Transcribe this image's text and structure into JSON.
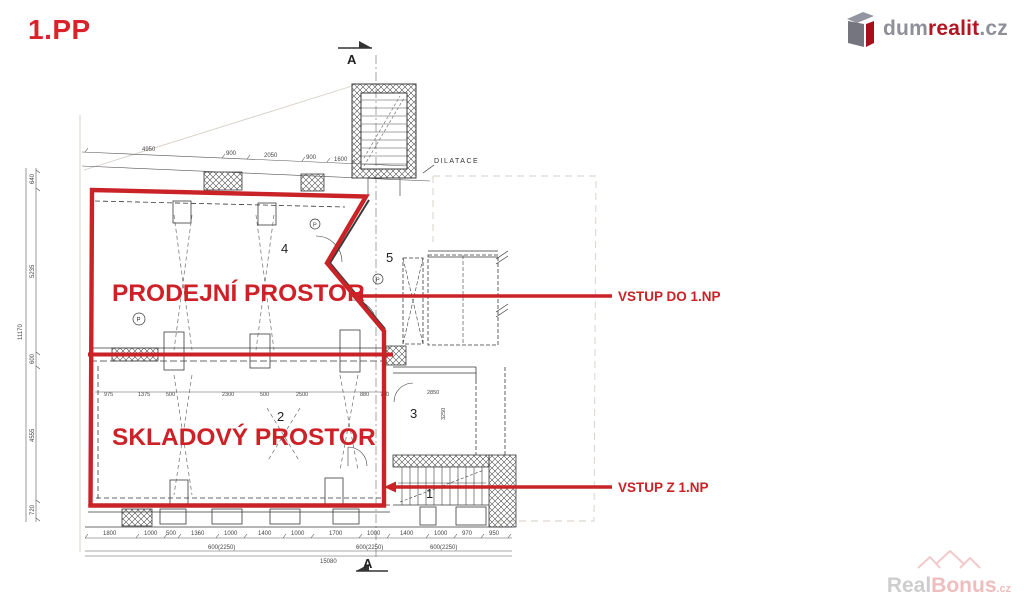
{
  "page": {
    "title": "1.PP"
  },
  "logo": {
    "part1": "dum",
    "part2": "realit",
    "part3": ".cz"
  },
  "watermark": {
    "part1": "Real",
    "part2": "Bonus",
    "part3": ".cz"
  },
  "annotations": {
    "sales_label": "PRODEJNÍ PROSTOR",
    "storage_label": "SKLADOVÝ PROSTOR",
    "entrance_to": "VSTUP DO 1.NP",
    "entrance_from": "VSTUP Z 1.NP",
    "accent_color": "#c92227"
  },
  "plan": {
    "rooms": [
      "1",
      "2",
      "3",
      "4",
      "5"
    ],
    "section_marker": "A",
    "dilatace": "DILATACE",
    "p_symbol": "P",
    "dims": {
      "top": [
        "4950",
        "900",
        "2050",
        "900",
        "1600"
      ],
      "left": [
        "640",
        "5235",
        "600",
        "4555",
        "720"
      ],
      "left_total": "11170",
      "mid": [
        "975",
        "1375",
        "500",
        "2300",
        "500",
        "2500",
        "880",
        "750"
      ],
      "room3": [
        "2850",
        "3250"
      ],
      "bottom": [
        "1800",
        "1000",
        "500",
        "1360",
        "1000",
        "1400",
        "1000",
        "1700",
        "1000",
        "1400",
        "1000",
        "970",
        "950"
      ],
      "bottom_sub": [
        "600(2250)",
        "600(2250)",
        "600(2250)"
      ],
      "bottom_total": "15080"
    }
  }
}
